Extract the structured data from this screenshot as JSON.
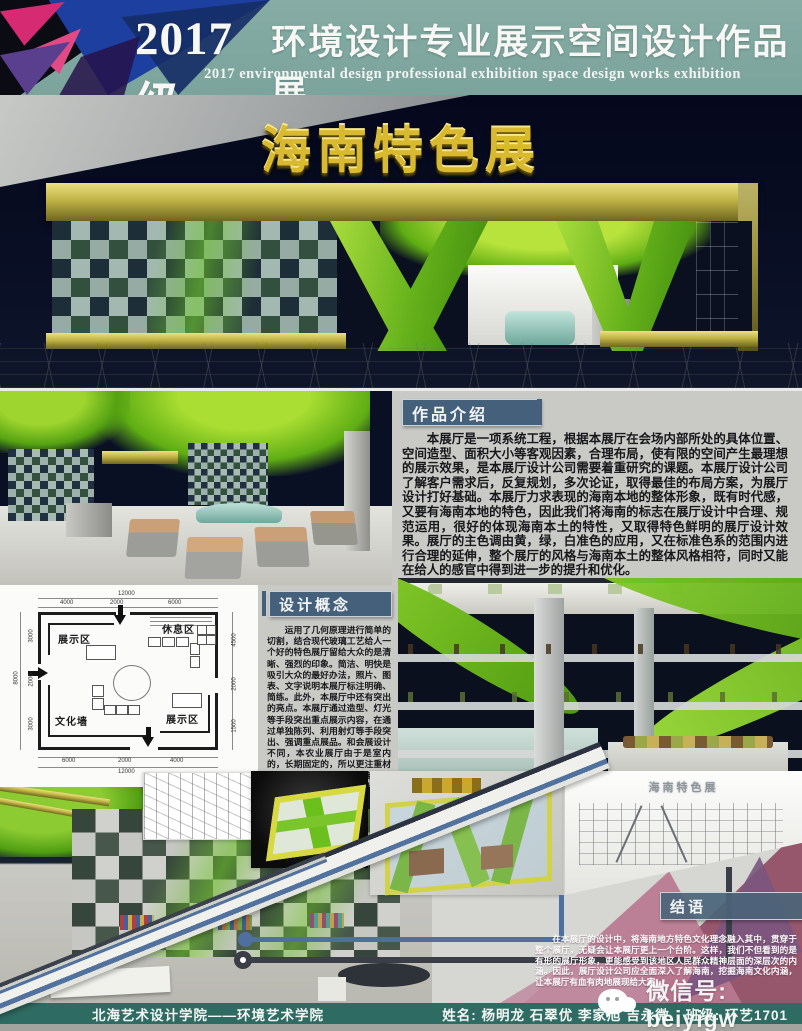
{
  "header": {
    "title_prefix": "2017级",
    "title_rest": "环境设计专业展示空间设计作品展",
    "subtitle": "2017 environmental design professional exhibition space design works exhibition"
  },
  "hero": {
    "signage": "海南特色展"
  },
  "intro": {
    "heading": "作品介绍",
    "body": "本展厅是一项系统工程，根据本展厅在会场内部所处的具体位置、空间造型、面积大小等客观因素，合理布局，使有限的空间产生最理想的展示效果，是本展厅设计公司需要着重研究的课题。本展厅设计公司了解客户需求后，反复规划，多次论证，取得最佳的布局方案，为展厅设计打好基础。本展厅力求表现的海南本地的整体形象，既有时代感，又要有海南本地的特色，因此我们将海南的标志在展厅设计中合理、规范运用，很好的体现海南本土的特性，又取得特色鲜明的展厅设计效果。展厅的主色调由黄，绿，白准色的应用，又在标准色系的范围内进行合理的延伸，整个展厅的风格与海南本土的整体风格相符，同时又能在给人的感官中得到进一步的提升和优化。"
  },
  "concept": {
    "heading": "设计概念",
    "body": "运用了几何原理进行简单的切割，结合现代玻璃工艺给人一个好的特色展厅留给大众的是清晰、强烈的印象。简洁、明快是吸引大众的最好办法，照片、图表、文字说明本展厅标注明确、简练。此外，本展厅中还有突出的亮点。本展厅通过造型、灯光等手段突出重点展示内容，在通过单独陈列、利用射灯等手段突出、强调重点展品。和会展设计不同，本农业展厅由于是室内的，长期固定的，所以更注重材料的选择。展厅体现的是海南的人土和风情，因此在选材上很有讲究，合理并创造性的应用新工艺新材料，以及海南本土代有代表性的工艺制品，很大程度上会提升展厅的整体效果。不像会展空间，基本只能选择一些简单的饰面。"
  },
  "floorplan": {
    "labels": {
      "top_left": "展示区",
      "top_right": "休息区",
      "bottom_left": "文化墙",
      "bottom_right": "展示区"
    },
    "dims": {
      "top_total": "12000",
      "top_segments": [
        "4000",
        "2000",
        "6000"
      ],
      "bottom_segments": [
        "6000",
        "2000",
        "4000"
      ],
      "bottom_total": "12000",
      "left_total": "8000",
      "left_segments": [
        "3000",
        "2000",
        "3000"
      ],
      "right_segments": [
        "4500",
        "2000",
        "1500"
      ]
    }
  },
  "bottom": {
    "sketch_sign": "海南特色展"
  },
  "conclusion": {
    "heading": "结语",
    "body": "在本展厅的设计中，将海南地方特色文化理念融入其中，贯穿于整个展厅，无疑会让本展厅更上一个台阶。这样，我们不但看到的是有形的展厅形象，更能感受到该地区人民群众精神层面的深层次的内涵。因此，展厅设计公司应全面深入了解海南，挖掘海南文化内涵，让本展厅有血有肉地展现给大家。"
  },
  "watermark": {
    "wechat_label": "微信号: beiyigw"
  },
  "footer": {
    "school": "北海艺术设计学院——环境艺术学院",
    "names_label": "姓名: 杨明龙 石翠优 李家旭 吉永微",
    "class_label": "班级: 环艺1701"
  },
  "colors": {
    "header_teal": "#7ba49c",
    "heading_box_slate": "#45607a",
    "footer_teal": "#2e6b62",
    "booth_green": "#6cc01e",
    "gold": "#c0b345",
    "deco_magenta": "#d62a72",
    "deco_blue": "#1d3f9f",
    "deco_pink": "#b87890"
  }
}
